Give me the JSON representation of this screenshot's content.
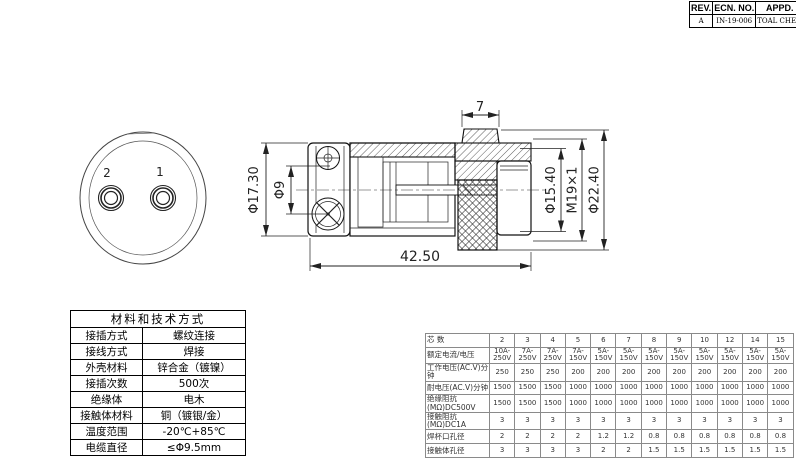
{
  "revision_table": {
    "headers": [
      "REV.",
      "ECN. NO.",
      "APPD."
    ],
    "row": [
      "A",
      "IN-19-006",
      "TOAL CHEN"
    ]
  },
  "front_view": {
    "pin_labels": [
      "2",
      "1"
    ]
  },
  "side_view": {
    "dim_tab_width": "7",
    "dim_length": "42.50",
    "dim_front_od": "Φ17.30",
    "dim_cable_hole": "Φ9",
    "dim_inner_od": "Φ15.40",
    "dim_thread": "M19×1",
    "dim_outer_od": "Φ22.40"
  },
  "materials_table": {
    "title": "材料和技术方式",
    "rows": [
      [
        "接插方式",
        "螺纹连接"
      ],
      [
        "接线方式",
        "焊接"
      ],
      [
        "外壳材料",
        "锌合金（镀镍）"
      ],
      [
        "接插次数",
        "500次"
      ],
      [
        "绝缘体",
        "电木"
      ],
      [
        "接触体材料",
        "铜（镀银/金）"
      ],
      [
        "温度范围",
        "-20℃+85℃"
      ],
      [
        "电缆直径",
        "≤Φ9.5mm"
      ]
    ]
  },
  "spec_table": {
    "rows": [
      {
        "label": "芯 数",
        "values": [
          "2",
          "3",
          "4",
          "5",
          "6",
          "7",
          "8",
          "9",
          "10",
          "12",
          "14",
          "15"
        ]
      },
      {
        "label": "额定电流/电压",
        "values": [
          "10A-250V",
          "7A-250V",
          "7A-250V",
          "7A-150V",
          "5A-150V",
          "5A-150V",
          "5A-150V",
          "5A-150V",
          "5A-150V",
          "5A-150V",
          "5A-150V",
          "5A-150V"
        ]
      },
      {
        "label": "工作电压(AC.V)分钟",
        "values": [
          "250",
          "250",
          "250",
          "200",
          "200",
          "200",
          "200",
          "200",
          "200",
          "200",
          "200",
          "200"
        ]
      },
      {
        "label": "耐电压(AC.V)分钟",
        "values": [
          "1500",
          "1500",
          "1500",
          "1000",
          "1000",
          "1000",
          "1000",
          "1000",
          "1000",
          "1000",
          "1000",
          "1000"
        ]
      },
      {
        "label": "绝缘阻抗(MΩ)DC500V",
        "values": [
          "1500",
          "1500",
          "1500",
          "1000",
          "1000",
          "1000",
          "1000",
          "1000",
          "1000",
          "1000",
          "1000",
          "1000"
        ]
      },
      {
        "label": "接触阻抗(MΩ)DC1A",
        "values": [
          "3",
          "3",
          "3",
          "3",
          "3",
          "3",
          "3",
          "3",
          "3",
          "3",
          "3",
          "3"
        ]
      },
      {
        "label": "焊杯口孔径",
        "values": [
          "2",
          "2",
          "2",
          "2",
          "1.2",
          "1.2",
          "0.8",
          "0.8",
          "0.8",
          "0.8",
          "0.8",
          "0.8"
        ]
      },
      {
        "label": "接触体孔径",
        "values": [
          "3",
          "3",
          "3",
          "3",
          "2",
          "2",
          "1.5",
          "1.5",
          "1.5",
          "1.5",
          "1.5",
          "1.5"
        ]
      }
    ]
  },
  "colors": {
    "line": "#111111",
    "dim_line": "#222222",
    "table_border": "#8a8a8a",
    "background": "#ffffff"
  }
}
